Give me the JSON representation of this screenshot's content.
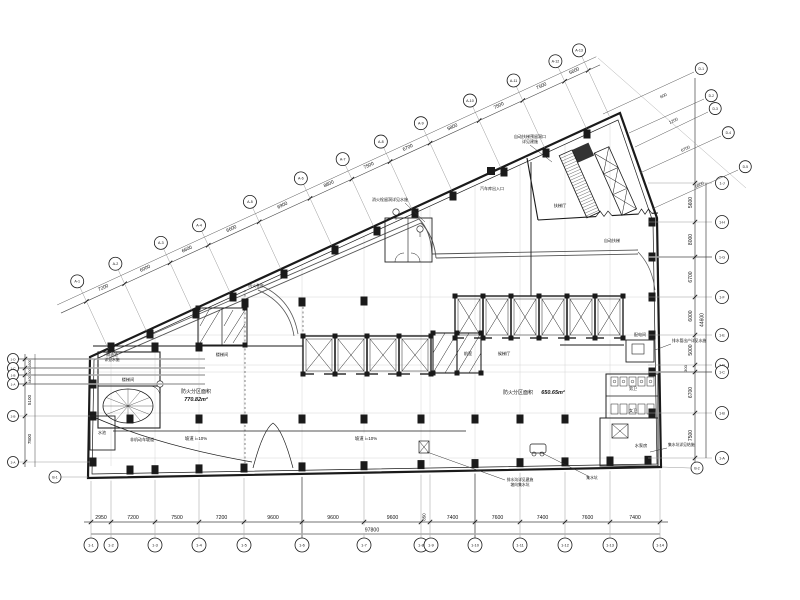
{
  "colors": {
    "ink": "#1a1a1a",
    "dim_line": "#444444",
    "extension": "#999999",
    "faint_grid": "#cccccc",
    "highlight_gray": "#aaaaaa",
    "wall": "#222222"
  },
  "dim_bottom": {
    "values": [
      "2950",
      "7200",
      "7500",
      "7200",
      "9600",
      "9600",
      "9600",
      "850",
      "7400",
      "7600",
      "7400",
      "7600",
      "7400"
    ],
    "total": "97800",
    "bubbles": [
      "1-1",
      "1-2",
      "1-3",
      "1-4",
      "1-5",
      "1-6",
      "1-7",
      "1-8",
      "1-9",
      "1-10",
      "1-11",
      "1-12",
      "1-13",
      "1-14"
    ]
  },
  "dim_right": {
    "values": [
      "5600",
      "8000",
      "6700",
      "6000",
      "5000",
      "300",
      "6700",
      "7500"
    ],
    "total": "44600",
    "bubbles": [
      "1-J",
      "1-H",
      "1-G",
      "1-F",
      "1-E",
      "1-D",
      "1-C",
      "1-B",
      "1-A"
    ]
  },
  "dim_left": {
    "values": [
      "1600",
      "300",
      "4400",
      "5100",
      "7800"
    ],
    "bubbles": [
      "1-D",
      "1-C",
      "1-B",
      "1-A",
      "2-B",
      "2-A"
    ]
  },
  "dim_diag": {
    "values": [
      "7200",
      "6000",
      "6600",
      "6600",
      "6900",
      "8800",
      "7500",
      "6700",
      "5800",
      "7500",
      "7500",
      "5600"
    ],
    "bubbles": [
      "A-1",
      "A-2",
      "A-3",
      "A-4",
      "A-5",
      "A-6",
      "A-7",
      "A-8",
      "A-9",
      "A-10",
      "A-11",
      "A-12",
      "A-13"
    ]
  },
  "dim_fan": {
    "values": [
      "600",
      "1200",
      "6700",
      "5800"
    ],
    "bubbles": [
      "D-1",
      "D-2",
      "D-3",
      "D-4",
      "D-5"
    ]
  },
  "aux_bubbles": [
    "B-1",
    "B-2"
  ],
  "labels": {
    "zone1_name": "防火分区面积",
    "zone1_value": "770.82m²",
    "zone2_name": "防火分区面积",
    "zone2_value": "650.65m²",
    "stair": "楼梯间",
    "stair2": "楼梯间",
    "lobby1": "前室",
    "lobby2": "候梯厅",
    "esc_hall": "扶梯厅",
    "esc": "自动扶梯",
    "power": "配电间",
    "wc_m": "男卫",
    "wc_f": "女卫",
    "pump": "水泵房",
    "tank": "水池",
    "bike": "非机动车坡道",
    "ramp1": "坡道 i=10%",
    "ramp2": "坡道 i=10%"
  },
  "notes": {
    "n1a": "自动扶梯预留洞口",
    "n1b": "详见建施",
    "n2": "消火栓留洞详见水施",
    "n3": "汽车库出入口",
    "n4": "排水管出户详见水施",
    "n5": "集水坑详见结施",
    "n6a": "排水沟详见建施",
    "n6b": "坡向集水坑",
    "n7": "集水坑",
    "n8a": "隔油池",
    "n8b": "详见水施",
    "n9": "防火卷帘"
  }
}
